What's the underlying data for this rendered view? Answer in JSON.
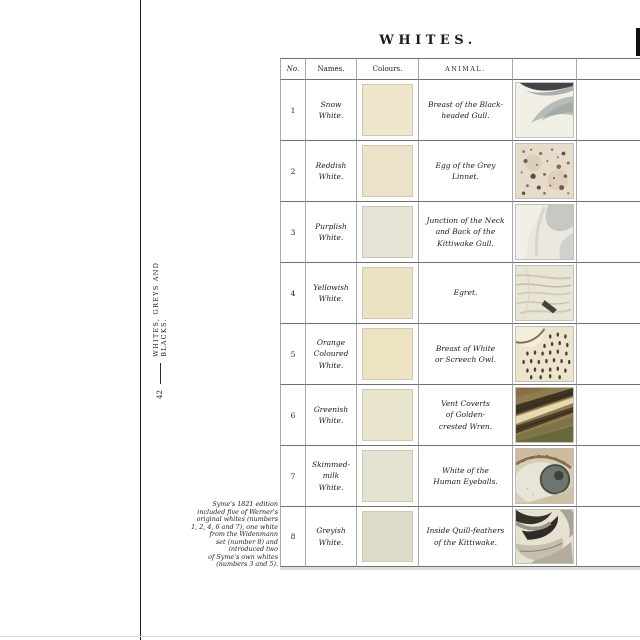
{
  "page": {
    "title": "WHITES.",
    "page_number": "42",
    "section_label": "WHITES, GREYS AND BLACKS.",
    "footnote": "Syme's 1821 edition\nincluded five of Werner's\noriginal whites (numbers\n1, 2, 4, 6 and 7), one white\nfrom the Widenmann\nset (number 8) and\nintroduced two\nof Syme's own whites\n(numbers 3 and 5)."
  },
  "table": {
    "headers": {
      "no": "No.",
      "names": "Names.",
      "colours": "Colours.",
      "animal": "ANIMAL."
    },
    "rows": [
      {
        "no": "1",
        "name": "Snow\nWhite.",
        "swatch": "#efe6cb",
        "animal": "Breast of the Black-\nheaded Gull.",
        "art": "gull-breast"
      },
      {
        "no": "2",
        "name": "Reddish\nWhite.",
        "swatch": "#ece2ca",
        "animal": "Egg of the Grey\nLinnet.",
        "art": "linnet-egg"
      },
      {
        "no": "3",
        "name": "Purplish\nWhite.",
        "swatch": "#e6e3d5",
        "animal": "Junction of the Neck\nand Back of the\nKittiwake Gull.",
        "art": "kittiwake-neck"
      },
      {
        "no": "4",
        "name": "Yellowish\nWhite.",
        "swatch": "#eae2c3",
        "animal": "Egret.",
        "art": "egret"
      },
      {
        "no": "5",
        "name": "Orange\nColoured\nWhite.",
        "swatch": "#ede3c2",
        "animal": "Breast of White\nor Screech Owl.",
        "art": "owl-breast"
      },
      {
        "no": "6",
        "name": "Greenish\nWhite.",
        "swatch": "#e9e5cc",
        "animal": "Vent Coverts\nof Golden-\ncrested Wren.",
        "art": "wren"
      },
      {
        "no": "7",
        "name": "Skimmed-\nmilk\nWhite.",
        "swatch": "#e3e1d0",
        "animal": "White of the\nHuman Eyeballs.",
        "art": "eye"
      },
      {
        "no": "8",
        "name": "Greyish\nWhite.",
        "swatch": "#dedac8",
        "animal": "Inside Quill-feathers\nof the Kittiwake.",
        "art": "quill-feathers"
      }
    ]
  }
}
